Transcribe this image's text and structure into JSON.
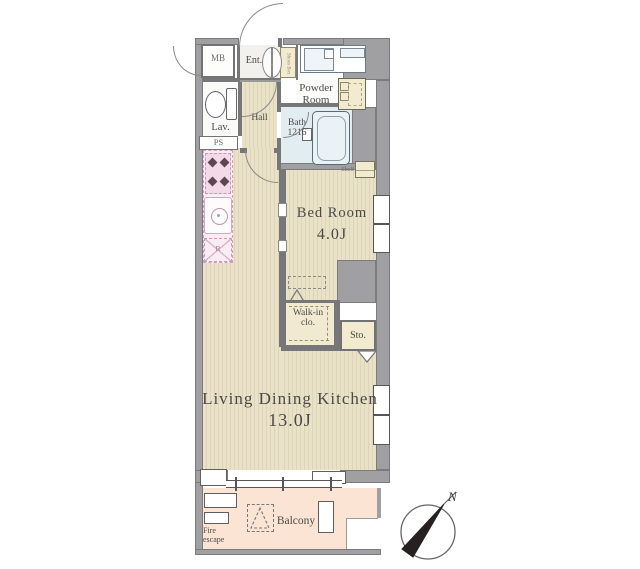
{
  "floorplan": {
    "rooms": {
      "mb": {
        "label": "MB"
      },
      "ent": {
        "label": "Ent."
      },
      "shoes": {
        "label": "Shoes Box"
      },
      "powder": {
        "label": "Powder Room"
      },
      "lav": {
        "label": "Lav."
      },
      "hall": {
        "label": "Hall"
      },
      "ps": {
        "label": "PS"
      },
      "bath": {
        "label": "Bath 1216"
      },
      "shelf": {
        "label": "Shelf"
      },
      "bedroom": {
        "label": "Bed Room",
        "size": "4.0J"
      },
      "walkin": {
        "label": "Walk-in clo."
      },
      "storage": {
        "label": "Sto."
      },
      "ldk": {
        "label": "Living Dining Kitchen",
        "size": "13.0J"
      },
      "balcony": {
        "label": "Balcony"
      },
      "fire_escape": {
        "label": "Fire escape"
      },
      "kitchen": {
        "fridge_label": "R"
      }
    },
    "compass": {
      "north_label": "N"
    },
    "colors": {
      "wall_gray": "#a0a0a3",
      "floor_tan": "#e9e2c8",
      "floor_stripe": "#ddd5b6",
      "balcony_pink": "#fbe4d4",
      "bath_blue": "#e2edf2",
      "kitchen_pink": "#f9ecf3",
      "cabinet_yellow": "#f2ebd0",
      "ink": "#4b4a46"
    }
  }
}
